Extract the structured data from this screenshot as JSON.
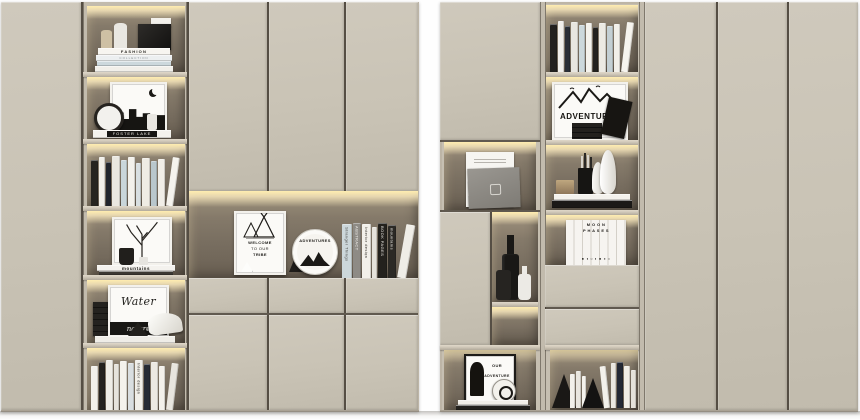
{
  "scene": {
    "description": "3D render of two beige built-in cabinet units with LED-lit open shelves holding books and decor objects",
    "colors": {
      "background": "#ffffff",
      "cabinet_face": "#c9c3b5",
      "frame": "#c2bbad",
      "panel_gap": "#4a4438",
      "led_glow": "#ffedb0",
      "niche_back": "#7a7063",
      "plinth": "#aaa294",
      "floor_shadow": "#a8a49c"
    }
  },
  "texts": {
    "fashion_title": "FASHION",
    "fashion_sub": "COLLECTION",
    "paris_label": "PARIS",
    "foster_lake": "FOSTER LAKE",
    "welcome_l1": "WELCOME",
    "welcome_l2": "TO OUR",
    "welcome_l3": "TRIBE",
    "plate_title": "ADVENTURES",
    "mountains_title": "mountains",
    "water_title": "Water",
    "nature_title": "nature",
    "adventures_frame": "ADVENTURES",
    "moon_l1": "M O O N",
    "moon_l2": "P H A S E S",
    "moon_icons": "● ◑ ○ ◐ ● ◑ ○",
    "poster_l1": "OUR",
    "poster_l2": "ADVENTURE"
  },
  "books": {
    "left_n3": [
      {
        "w": 7,
        "h": 46,
        "c": "#262420"
      },
      {
        "w": 6,
        "h": 49,
        "c": "#f1efe9"
      },
      {
        "w": 5,
        "h": 44,
        "c": "#20242c"
      },
      {
        "w": 8,
        "h": 50,
        "c": "#e9e7e0"
      },
      {
        "w": 6,
        "h": 46,
        "c": "#c9d6da"
      },
      {
        "w": 7,
        "h": 49,
        "c": "#f3f1eb"
      },
      {
        "w": 5,
        "h": 43,
        "c": "#d8dfe1"
      },
      {
        "w": 8,
        "h": 48,
        "c": "#efece4"
      },
      {
        "w": 6,
        "h": 45,
        "c": "#b9c7cc"
      },
      {
        "w": 7,
        "h": 47,
        "c": "#f1eee7"
      },
      {
        "w": 7,
        "h": 49,
        "c": "#f5f3ed",
        "lean": 8
      }
    ],
    "left_n6": [
      {
        "w": 7,
        "h": 44,
        "c": "#f2f0ea"
      },
      {
        "w": 6,
        "h": 48,
        "c": "#24221f"
      },
      {
        "w": 7,
        "h": 50,
        "c": "#efede7"
      },
      {
        "w": 5,
        "h": 46,
        "c": "#e6e3dc"
      },
      {
        "w": 7,
        "h": 49,
        "c": "#f4f2ec"
      },
      {
        "w": 6,
        "h": 47,
        "c": "#d9dee0"
      },
      {
        "w": 8,
        "h": 50,
        "c": "#f1efe9",
        "t": "Interior design",
        "tc": "#35322d"
      },
      {
        "w": 6,
        "h": 46,
        "c": "#262b35"
      },
      {
        "w": 7,
        "h": 48,
        "c": "#ece9e2"
      },
      {
        "w": 6,
        "h": 44,
        "c": "#f3f1eb"
      },
      {
        "w": 7,
        "h": 47,
        "c": "#e8e5de",
        "lean": 7
      }
    ],
    "center_niche": [
      {
        "w": 10,
        "h": 54,
        "c": "#ccd7da",
        "t": "Stranger Things",
        "tc": "#4a4a48"
      },
      {
        "w": 8,
        "h": 55,
        "c": "#8e8b85",
        "t": "ABSTRACT",
        "tc": "#f4f2ee"
      },
      {
        "w": 9,
        "h": 54,
        "c": "#f2f0ea",
        "t": "Interior design",
        "tc": "#38352f"
      },
      {
        "w": 5,
        "h": 51,
        "c": "#e5e2db"
      },
      {
        "w": 9,
        "h": 55,
        "c": "#23211d",
        "t": "BOOK PAGES",
        "tc": "#efede8"
      },
      {
        "w": 8,
        "h": 53,
        "c": "#2b2925",
        "t": "mountains",
        "tc": "#efede8"
      },
      {
        "w": 9,
        "h": 54,
        "c": "#efede7",
        "lean": 10
      }
    ],
    "right_e1": [
      {
        "w": 7,
        "h": 48,
        "c": "#23211f"
      },
      {
        "w": 6,
        "h": 51,
        "c": "#f1efeb"
      },
      {
        "w": 5,
        "h": 46,
        "c": "#2a2e36"
      },
      {
        "w": 7,
        "h": 50,
        "c": "#e8e6e0"
      },
      {
        "w": 6,
        "h": 47,
        "c": "#ccd8db"
      },
      {
        "w": 6,
        "h": 49,
        "c": "#f4f2ec"
      },
      {
        "w": 5,
        "h": 45,
        "c": "#23211e"
      },
      {
        "w": 7,
        "h": 49,
        "c": "#eceae3"
      },
      {
        "w": 6,
        "h": 46,
        "c": "#c3cfd3"
      },
      {
        "w": 6,
        "h": 48,
        "c": "#f1efe9"
      },
      {
        "w": 7,
        "h": 50,
        "c": "#f6f4ee",
        "lean": 7
      }
    ],
    "right_e5_mid": [
      {
        "w": 5,
        "h": 34,
        "c": "#f2f0ea"
      },
      {
        "w": 5,
        "h": 37,
        "c": "#e9e6df"
      },
      {
        "w": 4,
        "h": 32,
        "c": "#f5f3ed"
      }
    ],
    "right_e5_right": [
      {
        "w": 6,
        "h": 42,
        "c": "#f3f1eb",
        "lean": -6
      },
      {
        "w": 5,
        "h": 45,
        "c": "#eae7e0"
      },
      {
        "w": 6,
        "h": 46,
        "c": "#232834"
      },
      {
        "w": 6,
        "h": 42,
        "c": "#f0ede6"
      },
      {
        "w": 5,
        "h": 38,
        "c": "#e5e2da"
      }
    ]
  }
}
